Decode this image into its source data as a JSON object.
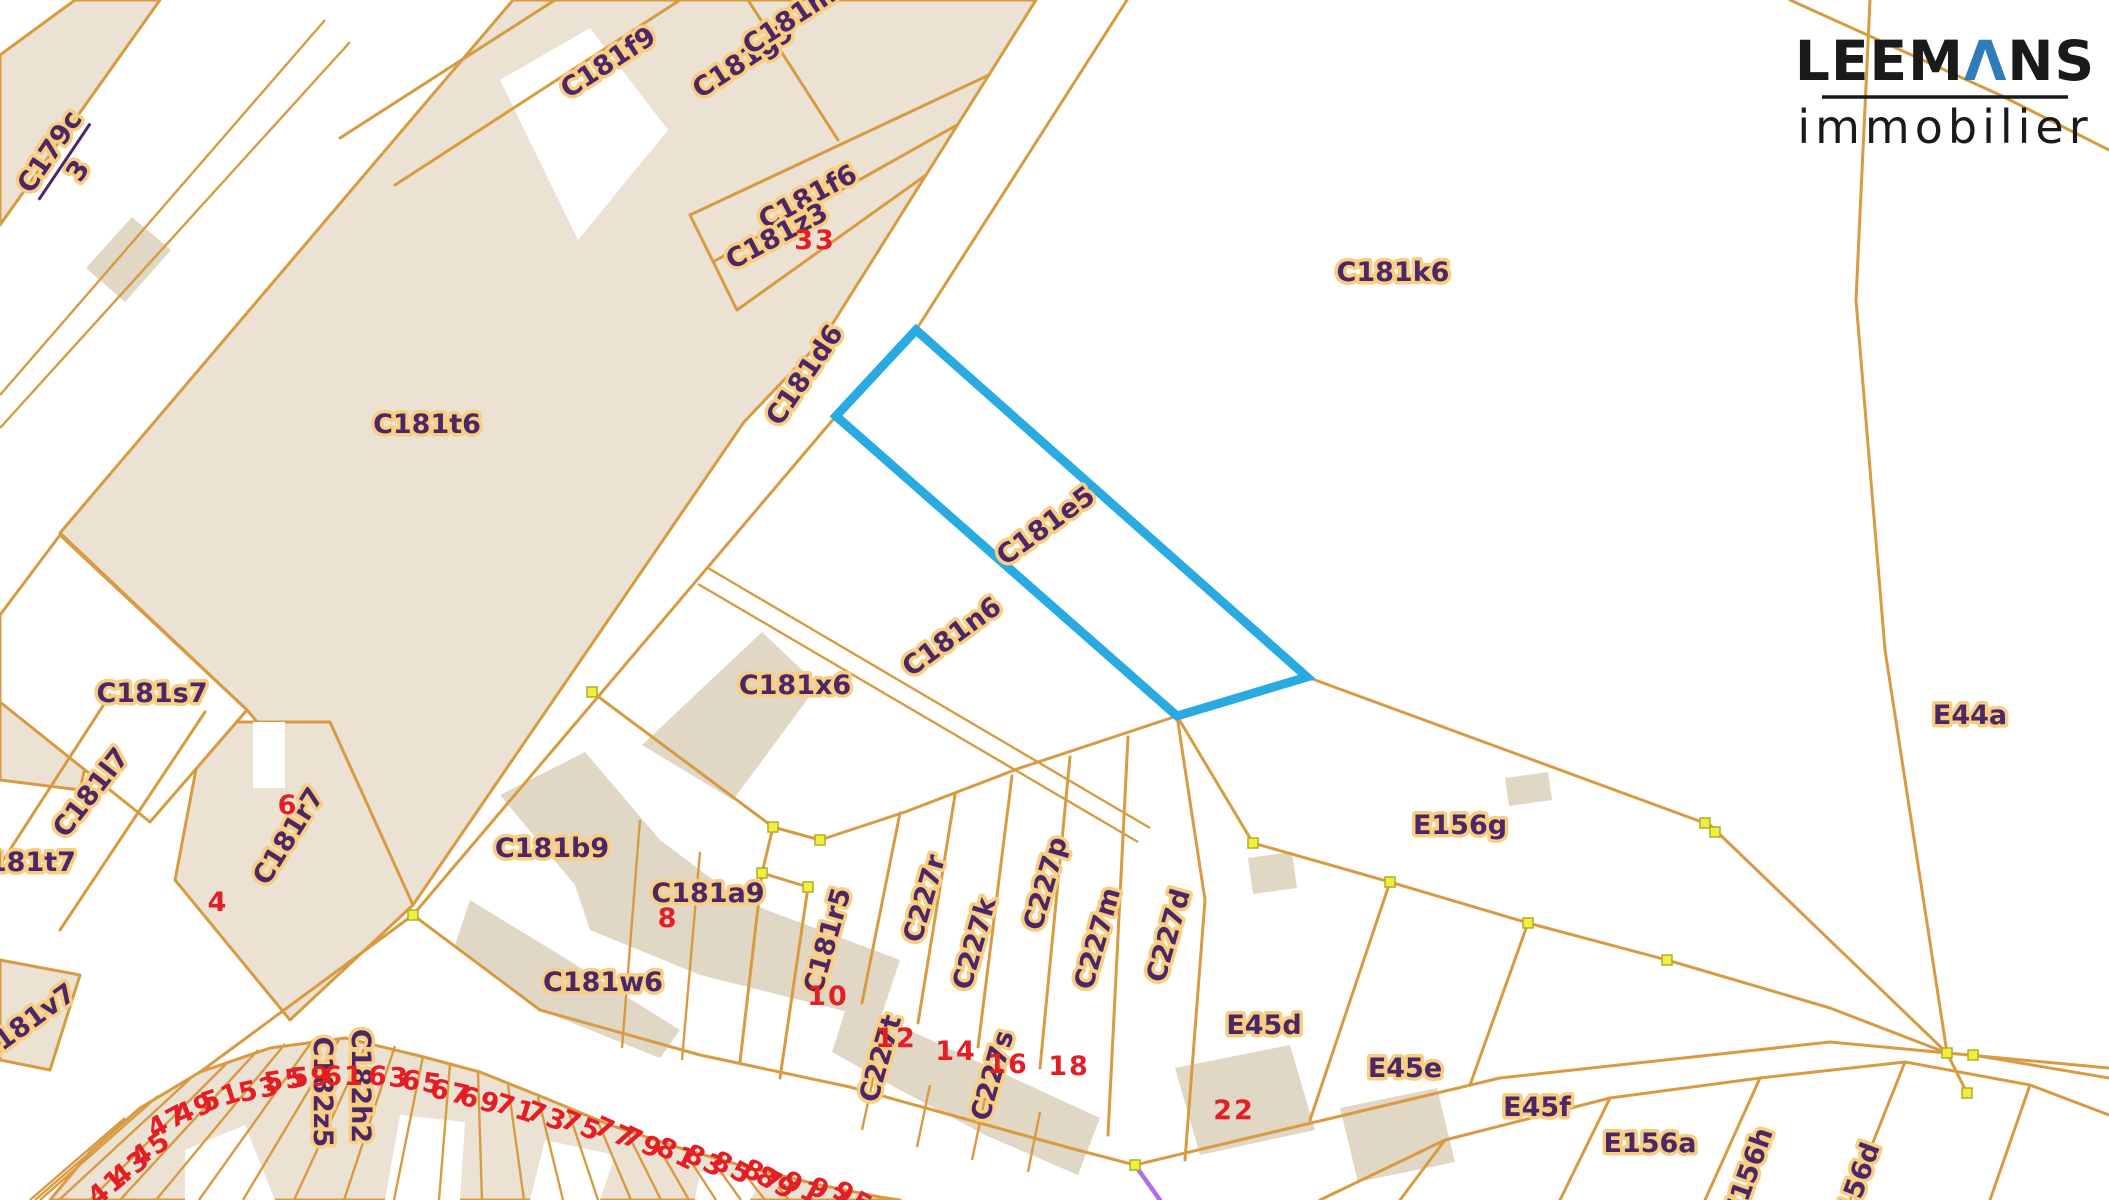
{
  "logo": {
    "name_pre": "LEEM",
    "name_lambda": "Λ",
    "name_post": "NS",
    "subtitle": "immobilier"
  },
  "colors": {
    "highlight_blue": "#29ABE2",
    "parcel_fill": "#EBE2D3",
    "building_fill": "#E1D7C5",
    "boundary_orange": "#D89B41",
    "label_purple": "#4B2767",
    "label_halo": "#F8CE82",
    "house_number_red": "#E31E24",
    "vertex_yellow": "#F2EE3E",
    "measure_purple": "#B76BE8"
  },
  "highlighted_parcel": "C181e5",
  "fraction_label": {
    "numerator": "C179c",
    "denominator": "3",
    "x": 62,
    "y": 160,
    "rot": -56
  },
  "parcel_labels": [
    {
      "text": "C181f9",
      "x": 613,
      "y": 70,
      "rot": -33
    },
    {
      "text": "C181g9",
      "x": 748,
      "y": 68,
      "rot": -33
    },
    {
      "text": "C181m6",
      "x": 802,
      "y": 22,
      "rot": -33
    },
    {
      "text": "C181f6",
      "x": 812,
      "y": 205,
      "rot": -28
    },
    {
      "text": "C181z3",
      "x": 781,
      "y": 244,
      "rot": -28
    },
    {
      "text": "C181d6",
      "x": 812,
      "y": 380,
      "rot": -56
    },
    {
      "text": "C181k6",
      "x": 1393,
      "y": 281,
      "rot": 0
    },
    {
      "text": "C181e5",
      "x": 1051,
      "y": 533,
      "rot": -36
    },
    {
      "text": "C181n6",
      "x": 957,
      "y": 644,
      "rot": -36
    },
    {
      "text": "C181t6",
      "x": 427,
      "y": 433,
      "rot": 0
    },
    {
      "text": "C181s7",
      "x": 152,
      "y": 702,
      "rot": 0
    },
    {
      "text": "C181l7",
      "x": 98,
      "y": 798,
      "rot": -52
    },
    {
      "text": "C181t7",
      "x": 22,
      "y": 871,
      "rot": 0
    },
    {
      "text": "C181r7",
      "x": 296,
      "y": 841,
      "rot": -58
    },
    {
      "text": "C181v7",
      "x": 32,
      "y": 1030,
      "rot": -36
    },
    {
      "text": "C181b9",
      "x": 552,
      "y": 857,
      "rot": 0
    },
    {
      "text": "C181x6",
      "x": 795,
      "y": 694,
      "rot": 0
    },
    {
      "text": "C181a9",
      "x": 708,
      "y": 902,
      "rot": 0
    },
    {
      "text": "C181w6",
      "x": 603,
      "y": 991,
      "rot": 0
    },
    {
      "text": "C181r5",
      "x": 836,
      "y": 943,
      "rot": -74
    },
    {
      "text": "C227r",
      "x": 933,
      "y": 901,
      "rot": -74
    },
    {
      "text": "C227k",
      "x": 983,
      "y": 946,
      "rot": -74
    },
    {
      "text": "C227p",
      "x": 1054,
      "y": 886,
      "rot": -74
    },
    {
      "text": "C227m",
      "x": 1106,
      "y": 941,
      "rot": -74
    },
    {
      "text": "C227d",
      "x": 1177,
      "y": 938,
      "rot": -74
    },
    {
      "text": "C227t",
      "x": 889,
      "y": 1061,
      "rot": -74
    },
    {
      "text": "C227s",
      "x": 1001,
      "y": 1078,
      "rot": -74
    },
    {
      "text": "E156g",
      "x": 1460,
      "y": 834,
      "rot": 0
    },
    {
      "text": "E45d",
      "x": 1264,
      "y": 1034,
      "rot": 0
    },
    {
      "text": "E45e",
      "x": 1405,
      "y": 1077,
      "rot": 0
    },
    {
      "text": "E45f",
      "x": 1537,
      "y": 1116,
      "rot": 0
    },
    {
      "text": "E156a",
      "x": 1650,
      "y": 1152,
      "rot": 0
    },
    {
      "text": "E156h",
      "x": 1757,
      "y": 1176,
      "rot": -70
    },
    {
      "text": "E156d",
      "x": 1864,
      "y": 1191,
      "rot": -70
    },
    {
      "text": "E44a",
      "x": 1970,
      "y": 724,
      "rot": 0
    },
    {
      "text": "C182z5",
      "x": 314,
      "y": 1092,
      "rot": 90
    },
    {
      "text": "C182h2",
      "x": 352,
      "y": 1086,
      "rot": 90
    }
  ],
  "house_numbers": [
    {
      "text": "33",
      "x": 815,
      "y": 249,
      "rot": 0
    },
    {
      "text": "6",
      "x": 288,
      "y": 814,
      "rot": 0
    },
    {
      "text": "4",
      "x": 218,
      "y": 911,
      "rot": 0
    },
    {
      "text": "8",
      "x": 668,
      "y": 927,
      "rot": 0
    },
    {
      "text": "10",
      "x": 828,
      "y": 1005,
      "rot": 0
    },
    {
      "text": "12",
      "x": 896,
      "y": 1047,
      "rot": 0
    },
    {
      "text": "14",
      "x": 956,
      "y": 1060,
      "rot": 0
    },
    {
      "text": "16",
      "x": 1008,
      "y": 1073,
      "rot": 0
    },
    {
      "text": "18",
      "x": 1069,
      "y": 1075,
      "rot": 0
    },
    {
      "text": "22",
      "x": 1234,
      "y": 1119,
      "rot": 0
    },
    {
      "text": "41",
      "x": 113,
      "y": 1194,
      "rot": -40
    },
    {
      "text": "43",
      "x": 136,
      "y": 1175,
      "rot": -38
    },
    {
      "text": "45",
      "x": 156,
      "y": 1156,
      "rot": -34
    },
    {
      "text": "47",
      "x": 172,
      "y": 1129,
      "rot": -28
    },
    {
      "text": "49",
      "x": 198,
      "y": 1117,
      "rot": -22
    },
    {
      "text": "51",
      "x": 224,
      "y": 1106,
      "rot": -18
    },
    {
      "text": "53",
      "x": 261,
      "y": 1098,
      "rot": -12
    },
    {
      "text": "55",
      "x": 286,
      "y": 1089,
      "rot": -8
    },
    {
      "text": "59",
      "x": 311,
      "y": 1086,
      "rot": -3
    },
    {
      "text": "61",
      "x": 344,
      "y": 1085,
      "rot": 0
    },
    {
      "text": "63",
      "x": 388,
      "y": 1086,
      "rot": 5
    },
    {
      "text": "65",
      "x": 421,
      "y": 1091,
      "rot": 8
    },
    {
      "text": "67",
      "x": 449,
      "y": 1101,
      "rot": 12
    },
    {
      "text": "69",
      "x": 478,
      "y": 1109,
      "rot": 15
    },
    {
      "text": "71",
      "x": 513,
      "y": 1117,
      "rot": 18
    },
    {
      "text": "73",
      "x": 544,
      "y": 1125,
      "rot": 20
    },
    {
      "text": "75",
      "x": 578,
      "y": 1134,
      "rot": 22
    },
    {
      "text": "77",
      "x": 611,
      "y": 1141,
      "rot": 24
    },
    {
      "text": "79",
      "x": 639,
      "y": 1151,
      "rot": 25
    },
    {
      "text": "81",
      "x": 673,
      "y": 1162,
      "rot": 26
    },
    {
      "text": "83",
      "x": 701,
      "y": 1169,
      "rot": 27
    },
    {
      "text": "85",
      "x": 728,
      "y": 1176,
      "rot": 28
    },
    {
      "text": "87",
      "x": 759,
      "y": 1184,
      "rot": 28
    },
    {
      "text": "89",
      "x": 772,
      "y": 1191,
      "rot": 29
    },
    {
      "text": "91",
      "x": 798,
      "y": 1196,
      "rot": 29
    },
    {
      "text": "93",
      "x": 824,
      "y": 1202,
      "rot": 30
    },
    {
      "text": "95",
      "x": 849,
      "y": 1206,
      "rot": 30
    }
  ]
}
